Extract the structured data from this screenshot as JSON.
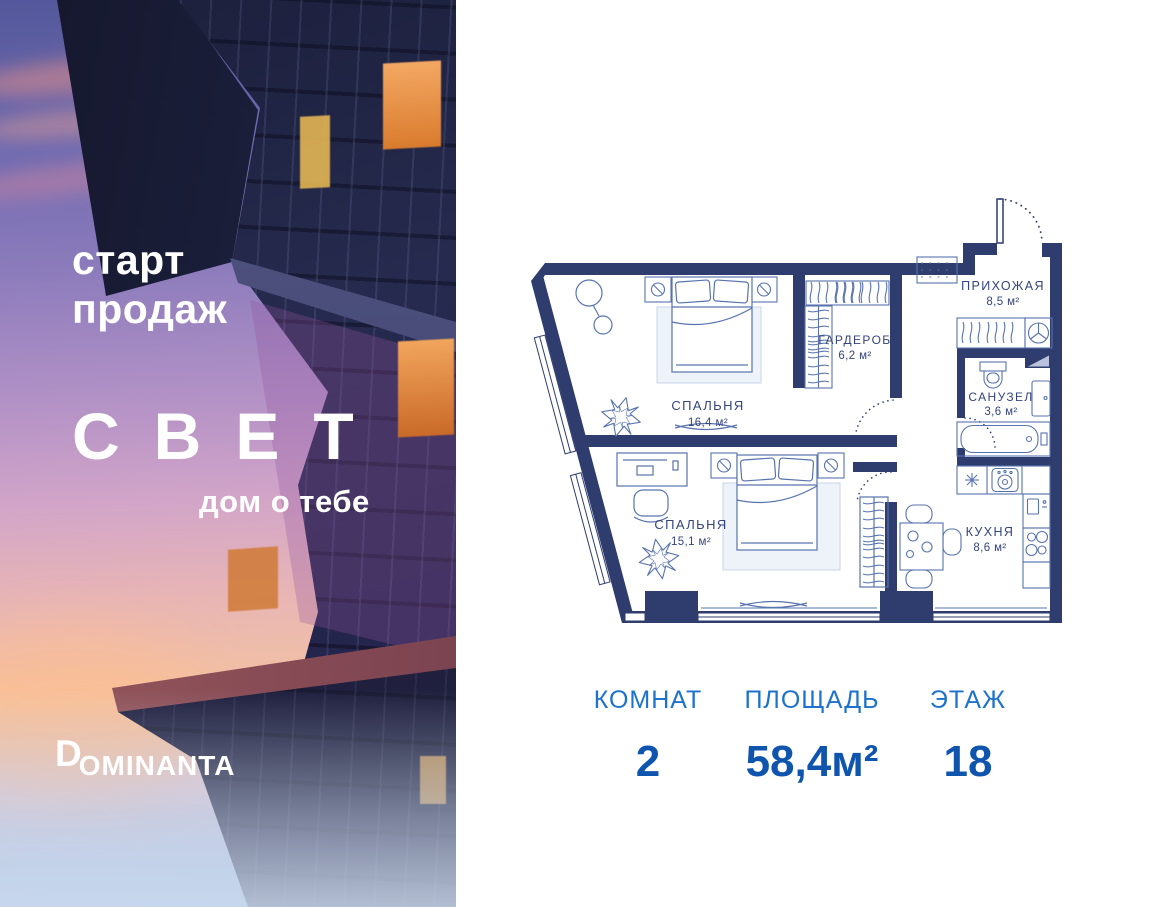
{
  "panel_left": {
    "start_sales_line1": "старт",
    "start_sales_line2": "продаж",
    "project_name": "СВЕТ",
    "tagline": "дом о тебе",
    "developer_logo": {
      "initial": "D",
      "rest": "OMINANTA"
    }
  },
  "floorplan": {
    "rooms": [
      {
        "id": "bedroom1",
        "name": "СПАЛЬНЯ",
        "area": "16,4 м²"
      },
      {
        "id": "wardrobe",
        "name": "ГАРДЕРОБ",
        "area": "6,2 м²"
      },
      {
        "id": "hallway",
        "name": "ПРИХОЖАЯ",
        "area": "8,5 м²"
      },
      {
        "id": "bathroom",
        "name": "САНУЗЕЛ",
        "area": "3,6 м²"
      },
      {
        "id": "bedroom2",
        "name": "СПАЛЬНЯ",
        "area": "15,1 м²"
      },
      {
        "id": "kitchen",
        "name": "КУХНЯ",
        "area": "8,6 м²"
      }
    ],
    "icons": [
      "entry-door-arc",
      "doormat",
      "coat-rack",
      "washing-machine-fan",
      "toilet",
      "mirror-cabinet",
      "bathtub",
      "kitchen-sink",
      "stove",
      "fridge-hob",
      "dining-table",
      "chairs",
      "double-bed",
      "nightstand-lamp",
      "pendant-lamp",
      "plant",
      "desk",
      "office-chair",
      "hanger-rack",
      "window",
      "curtain-swag"
    ]
  },
  "stats": {
    "rooms_label": "КОМНАТ",
    "rooms_value": "2",
    "area_label": "ПЛОЩАДЬ",
    "area_value": "58,4м²",
    "floor_label": "ЭТАЖ",
    "floor_value": "18"
  },
  "colors": {
    "wall_navy": "#2e3c6e",
    "furniture_blue": "#5873ae",
    "plan_label": "#35447c",
    "stat_label_blue": "#1d72cc",
    "stat_value_blue": "#0f55ad",
    "photo_text": "#ffffff"
  }
}
